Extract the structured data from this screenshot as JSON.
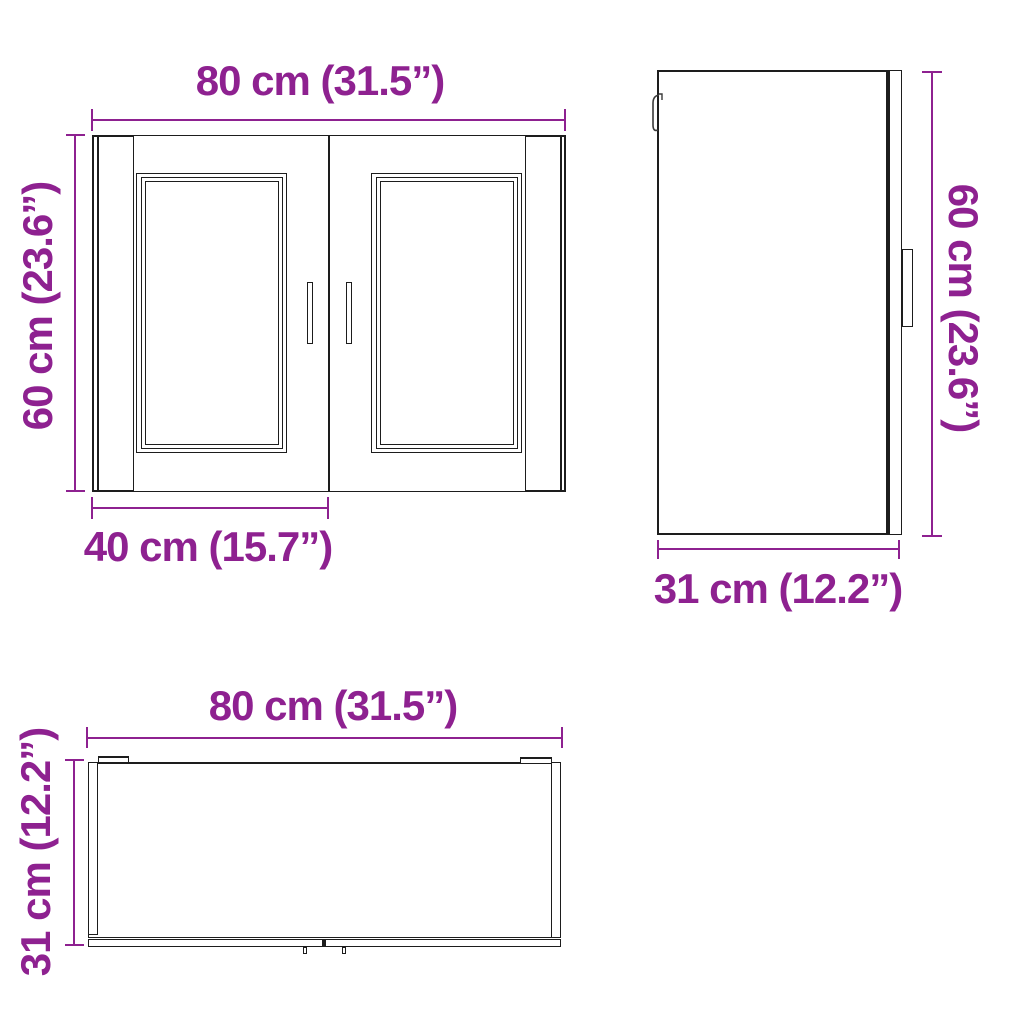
{
  "colors": {
    "accent": "#8e2190",
    "line": "#1d1d1d",
    "background": "#ffffff"
  },
  "diagram": {
    "type": "furniture-dimension-diagram",
    "item": "two-door wall cabinet",
    "views": {
      "front": {
        "width_label": "80 cm (31.5”)",
        "height_label": "60 cm (23.6”)",
        "door_width_label": "40 cm (15.7”)"
      },
      "side": {
        "height_label": "60 cm (23.6”)",
        "depth_label": "31 cm (12.2”)"
      },
      "top": {
        "width_label": "80 cm (31.5”)",
        "depth_label": "31 cm (12.2”)"
      }
    }
  }
}
